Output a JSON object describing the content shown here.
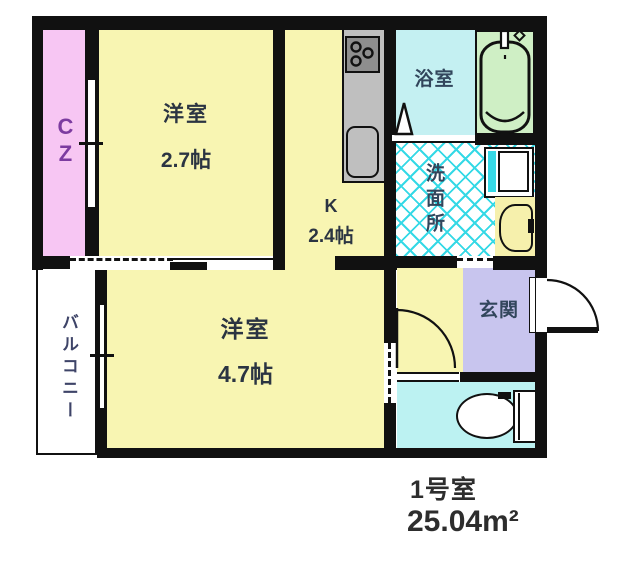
{
  "colors": {
    "wall": "#111111",
    "room_yellow": "#F8F5B2",
    "closet_pink": "#F7C6F3",
    "bath_cyan": "#C4F0F2",
    "toilet_cyan": "#BCF2F2",
    "tub_green": "#CFEFC5",
    "entry_purple": "#C8C5EE",
    "counter_gray": "#BFBFBF",
    "stove_gray": "#8E8E8E",
    "lattice_cyan": "#35D9E6",
    "vanity_yellow": "#F6F0AC",
    "label_dark": "#2B3442",
    "label_blue": "#32465C",
    "balcony_text": "#3E4468",
    "closet_text": "#7C3BA0",
    "caption_text": "#2D2D2D"
  },
  "plan": {
    "rooms": {
      "closet": {
        "label": "CZ"
      },
      "western_room_1": {
        "label": "洋室",
        "size": "2.7帖"
      },
      "kitchen": {
        "label": "K",
        "size": "2.4帖"
      },
      "bathroom": {
        "label": "浴室"
      },
      "washroom": {
        "label": "洗面所"
      },
      "entrance": {
        "label": "玄関"
      },
      "western_room_2": {
        "label": "洋室",
        "size": "4.7帖"
      },
      "balcony": {
        "label": "バルコニー"
      },
      "toilet_room": {
        "label": ""
      }
    },
    "icons": {
      "stove": "stove-burners-icon",
      "kitchen_sink": "kitchen-sink-icon",
      "bathtub": "bathtub-icon",
      "bath_door": "folding-door-triangle-icon",
      "washing_machine": "washing-machine-icon",
      "vanity_basin": "wash-basin-icon",
      "toilet": "toilet-icon",
      "entrance_door": "door-swing-arc-icon",
      "toilet_door": "door-swing-arc-icon"
    }
  },
  "caption": {
    "room_number": "1号室",
    "floor_area": "25.04m²"
  }
}
